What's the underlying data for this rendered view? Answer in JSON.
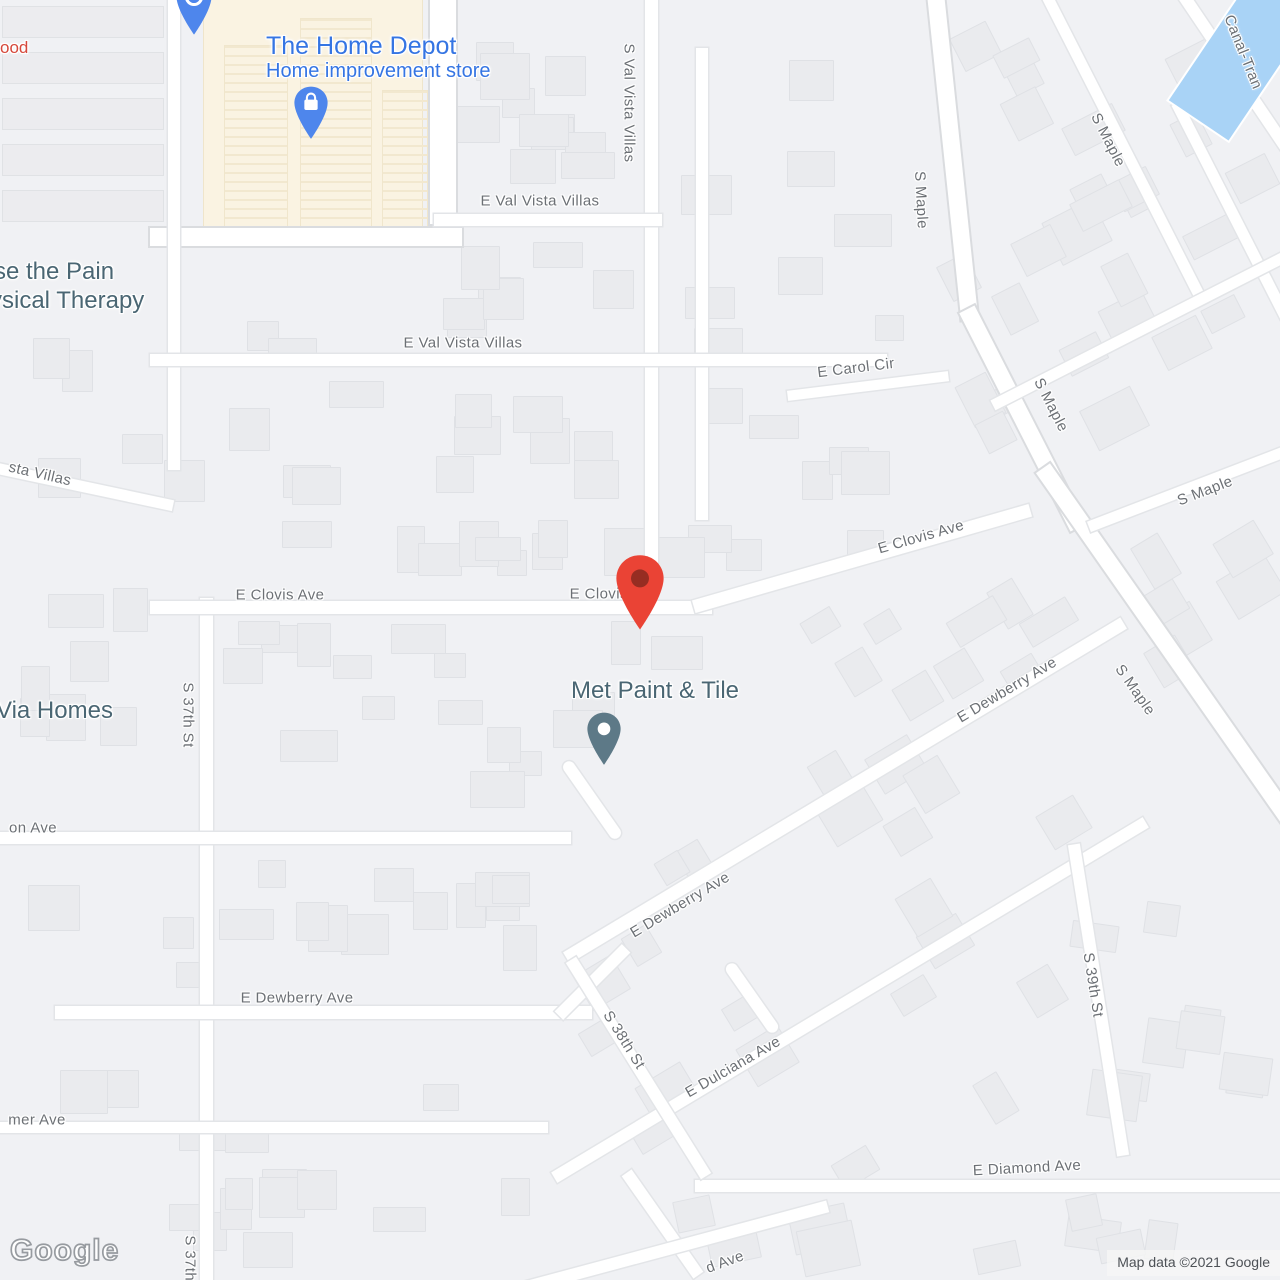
{
  "colors": {
    "water": "#a9d3f6",
    "commercial_area": "#faf3e2",
    "poi_blue": "#3575e3",
    "poi_red": "#d6483b",
    "poi_slate": "#4a6673",
    "street_label": "#6c7075",
    "pin_red": "#ea4335",
    "pin_red_inner": "#962d22",
    "pin_blue": "#4e86ec",
    "pin_slate": "#5d7987"
  },
  "pois": {
    "food_fragment": {
      "label": "ood"
    },
    "home_depot": {
      "title": "The Home Depot",
      "subtitle": "Home improvement store"
    },
    "physical_therapy": {
      "line1": "se the Pain",
      "line2": "ysical Therapy"
    },
    "via_homes": {
      "label": "Via Homes"
    },
    "met_paint_tile": {
      "label": "Met Paint & Tile"
    }
  },
  "pins": {
    "destination": {
      "name": "destination-pin",
      "color": "#ea4335",
      "inner": "#962d22"
    },
    "home_depot": {
      "name": "home-depot-store-pin",
      "color": "#4e86ec"
    },
    "restaurant": {
      "name": "restaurant-pin",
      "color": "#4e86ec"
    },
    "met_paint_tile": {
      "name": "met-paint-tile-pin",
      "color": "#5d7987"
    }
  },
  "street_labels": [
    {
      "text": "E Val Vista Villas",
      "x": 540,
      "y": 201,
      "rot": 0
    },
    {
      "text": "S Val Vista Villas",
      "x": 629,
      "y": 103,
      "rot": 90
    },
    {
      "text": "E Val Vista Villas",
      "x": 463,
      "y": 343,
      "rot": 0
    },
    {
      "text": "sta Villas",
      "x": 40,
      "y": 474,
      "rot": 13
    },
    {
      "text": "E Carol Cir",
      "x": 856,
      "y": 368,
      "rot": -7
    },
    {
      "text": "E Clovis Ave",
      "x": 921,
      "y": 537,
      "rot": -16
    },
    {
      "text": "E Clovis Ave",
      "x": 280,
      "y": 595,
      "rot": 0
    },
    {
      "text": "E Clovis Ave",
      "x": 614,
      "y": 594,
      "rot": 0
    },
    {
      "text": "S Maple",
      "x": 921,
      "y": 200,
      "rot": 87
    },
    {
      "text": "S Maple",
      "x": 1108,
      "y": 140,
      "rot": 63
    },
    {
      "text": "S Maple",
      "x": 1051,
      "y": 405,
      "rot": 63
    },
    {
      "text": "S Maple",
      "x": 1205,
      "y": 491,
      "rot": -21
    },
    {
      "text": "S Maple",
      "x": 1135,
      "y": 690,
      "rot": 55
    },
    {
      "text": "S 37th St",
      "x": 188,
      "y": 715,
      "rot": 90
    },
    {
      "text": "on Ave",
      "x": 33,
      "y": 828,
      "rot": 0
    },
    {
      "text": "E Dewberry Ave",
      "x": 1007,
      "y": 690,
      "rot": -31
    },
    {
      "text": "E Dewberry Ave",
      "x": 680,
      "y": 905,
      "rot": -31
    },
    {
      "text": "E Dewberry Ave",
      "x": 297,
      "y": 998,
      "rot": 0
    },
    {
      "text": "S 38th St",
      "x": 624,
      "y": 1040,
      "rot": 58
    },
    {
      "text": "E Dulciana Ave",
      "x": 733,
      "y": 1067,
      "rot": -30
    },
    {
      "text": "S 39th St",
      "x": 1093,
      "y": 985,
      "rot": 81
    },
    {
      "text": "E Diamond Ave",
      "x": 1027,
      "y": 1168,
      "rot": -3
    },
    {
      "text": "mer Ave",
      "x": 37,
      "y": 1120,
      "rot": 0
    },
    {
      "text": "S 37th St",
      "x": 190,
      "y": 1268,
      "rot": 90
    },
    {
      "text": "d Ave",
      "x": 725,
      "y": 1262,
      "rot": -20
    },
    {
      "text": "Canal-Tran",
      "x": 1243,
      "y": 52,
      "rot": 68
    }
  ],
  "watermark": {
    "text": "Google"
  },
  "attribution": {
    "text": "Map data ©2021 Google"
  }
}
